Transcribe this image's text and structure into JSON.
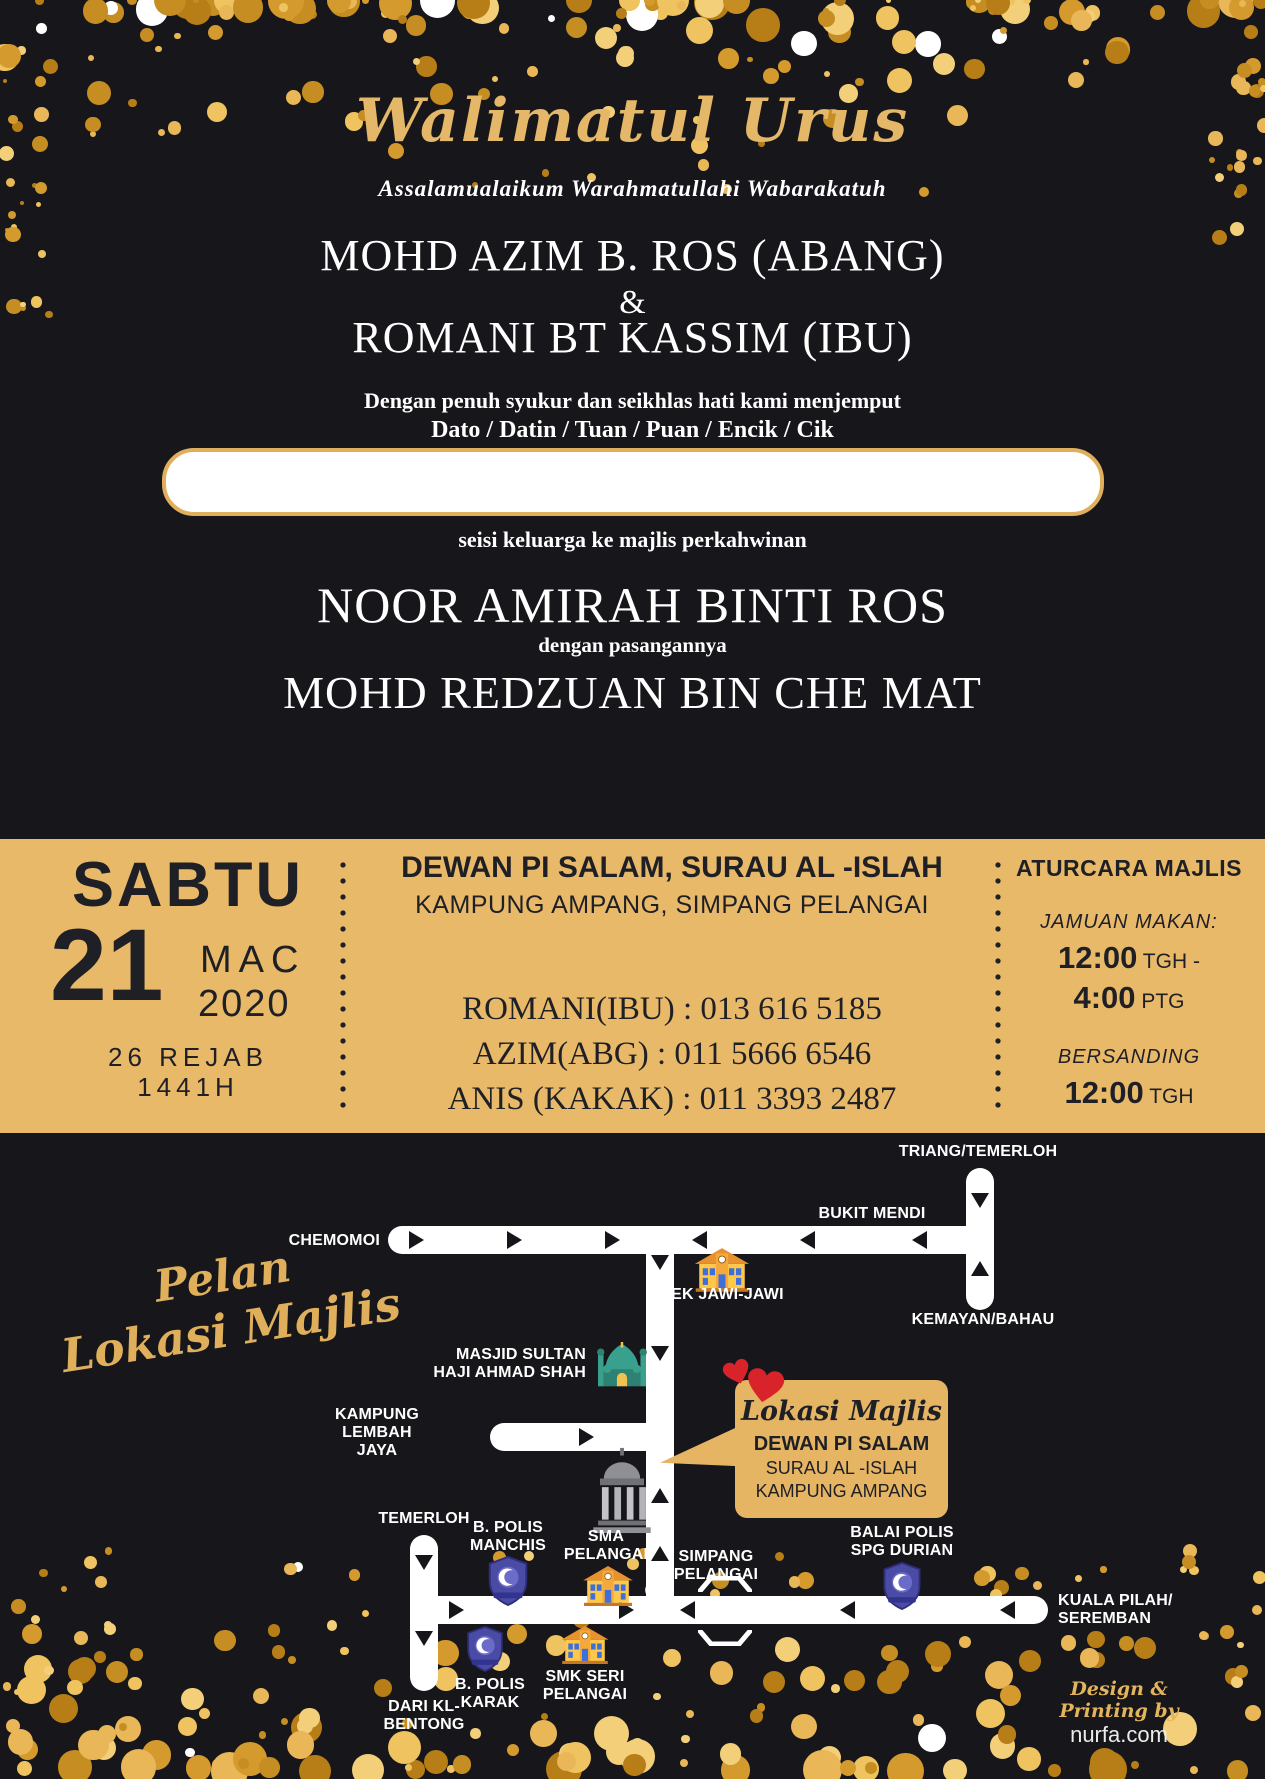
{
  "header": {
    "title": "Walimatul Urus",
    "salutation": "Assalamualaikum Warahmatullahi Wabarakatuh",
    "host1": "MOHD AZIM B. ROS (ABANG)",
    "ampersand": "&",
    "host2": "ROMANI BT KASSIM (IBU)",
    "invite1": "Dengan penuh syukur dan seikhlas hati kami menjemput",
    "invite2": "Dato / Datin / Tuan / Puan / Encik / Cik",
    "guest_name_value": "",
    "invite3": "seisi keluarga ke majlis perkahwinan",
    "bride": "NOOR AMIRAH BINTI ROS",
    "pasangan": "dengan pasangannya",
    "groom": "MOHD REDZUAN BIN CHE MAT"
  },
  "band": {
    "day": "SABTU",
    "day_num": "21",
    "month": "MAC",
    "year": "2020",
    "hijri1": "26 REJAB",
    "hijri2": "1441H",
    "venue1": "DEWAN PI SALAM, SURAU AL -ISLAH",
    "venue2": "KAMPUNG AMPANG, SIMPANG PELANGAI",
    "contact1": "ROMANI(IBU) : 013 616 5185",
    "contact2": "AZIM(ABG) : 011 5666 6546",
    "contact3": "ANIS (KAKAK) : 011 3393 2487",
    "agenda_title": "ATURCARA MAJLIS",
    "meal_label": "JAMUAN MAKAN:",
    "meal_start": "12:00",
    "meal_start_suffix": " TGH -",
    "meal_end": "4:00",
    "meal_end_suffix": " PTG",
    "bersanding_label": "BERSANDING",
    "bersanding_time": "12:00",
    "bersanding_suffix": " TGH"
  },
  "map": {
    "heading1": "Pelan",
    "heading2": "Lokasi Majlis",
    "labels": {
      "triang": "TRIANG/TEMERLOH",
      "bukit": "BUKIT MENDI",
      "chemomoi": "CHEMOMOI",
      "sek": "SEK JAWI-JAWI",
      "kemayan": "KEMAYAN/BAHAU",
      "masjid1": "MASJID SULTAN",
      "masjid2": "HAJI AHMAD SHAH",
      "kg1": "KAMPUNG",
      "kg2": "LEMBAH",
      "kg3": "JAYA",
      "temerloh": "TEMERLOH",
      "manchis1": "B. POLIS",
      "manchis2": "MANCHIS",
      "sma1": "SMA",
      "sma2": "PELANGAI",
      "simpang1": "SIMPANG",
      "simpang2": "PELANGAI",
      "balai1": "BALAI POLIS",
      "balai2": "SPG DURIAN",
      "kuala1": "KUALA PILAH/",
      "kuala2": "SEREMBAN",
      "smk1": "SMK SERI",
      "smk2": "PELANGAI",
      "karak1": "B. POLIS",
      "karak2": "KARAK",
      "dari1": "DARI KL-",
      "dari2": "BENTONG"
    },
    "callout": {
      "script": "Lokasi Majlis",
      "line1": "DEWAN PI SALAM",
      "line2": "SURAU AL -ISLAH",
      "line3": "KAMPUNG AMPANG"
    },
    "credit1": "Design & Printing by",
    "credit2": "nurfa.com"
  },
  "icons": {
    "school": "school-building-icon",
    "mosque": "mosque-icon",
    "police": "police-badge-icon",
    "hall": "hall-building-icon",
    "hearts": "hearts-icon"
  },
  "colors": {
    "background": "#17171B",
    "band_gold": "#E8B968",
    "title_gold": "#E5B768",
    "script_gold": "#DFAF5B",
    "callout_gold": "#E5B564",
    "heart_red": "#D8232A",
    "road_white": "#FFFFFF",
    "dark_text": "#1F1F26",
    "confetti_palette": [
      "#E9B757",
      "#D49A2E",
      "#F3CF7A",
      "#C68E22",
      "#B77E18",
      "#EFC35F"
    ]
  }
}
